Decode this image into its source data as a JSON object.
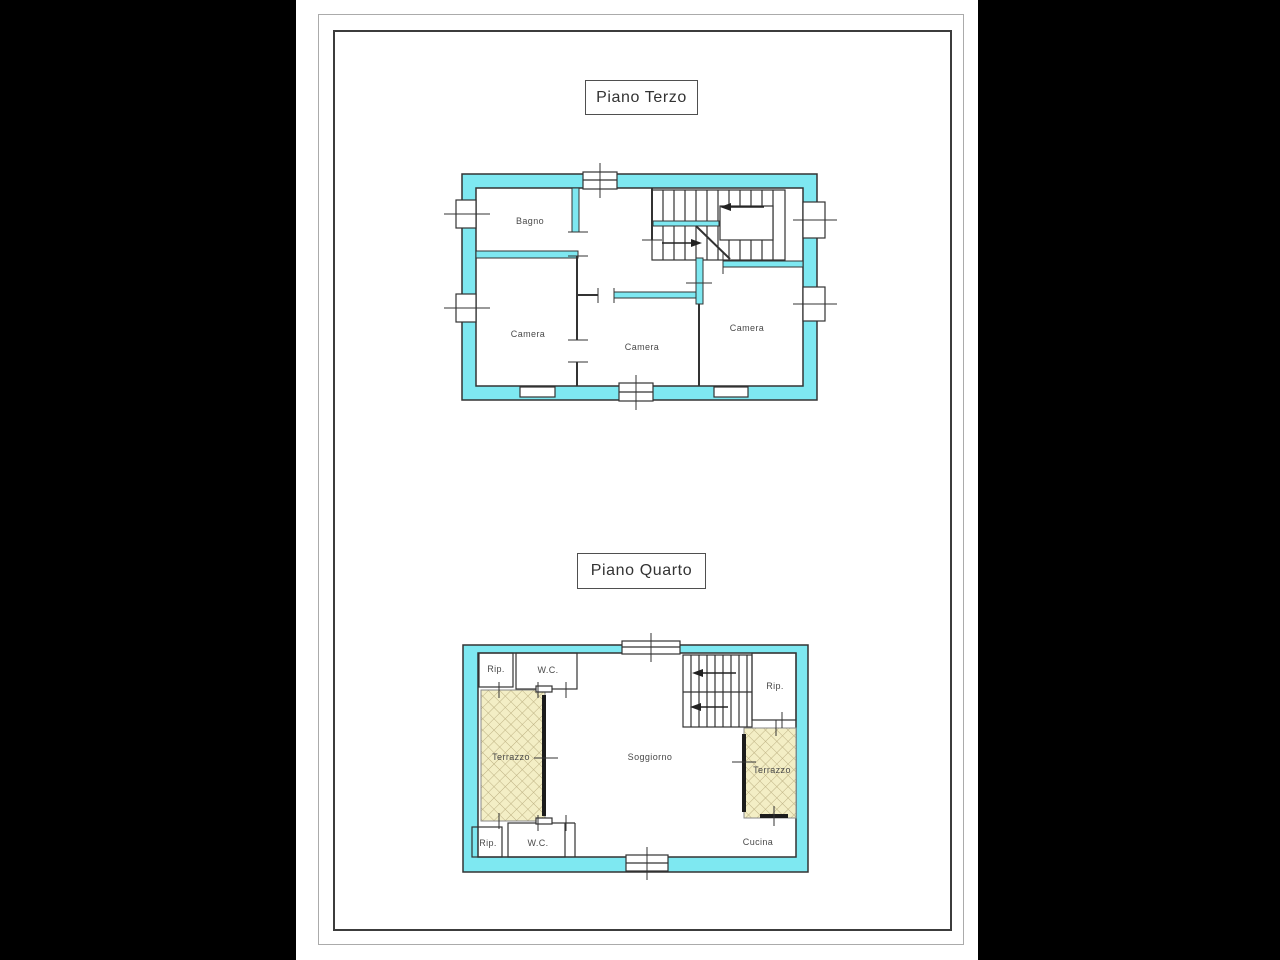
{
  "document": {
    "kind": "floor-plan-sheet"
  },
  "colors": {
    "canvas-bg": "#000000",
    "paper-color": "#ffffff",
    "wall-fill": "#7ee8f1",
    "wall-stroke": "#333333",
    "terrace-fill": "#f3eec5",
    "terrace-hatch": "#bdb183",
    "label-color": "#4a4a4a",
    "title-color": "#333333"
  },
  "floor_plans": [
    {
      "title": "Piano Terzo",
      "rooms": [
        "Bagno",
        "Camera",
        "Camera",
        "Camera"
      ]
    },
    {
      "title": "Piano Quarto",
      "rooms": [
        "Rip.",
        "W.C.",
        "Terrazzo",
        "Soggiorno",
        "Rip.",
        "Terrazzo",
        "Rip.",
        "W.C.",
        "Cucina"
      ]
    }
  ]
}
